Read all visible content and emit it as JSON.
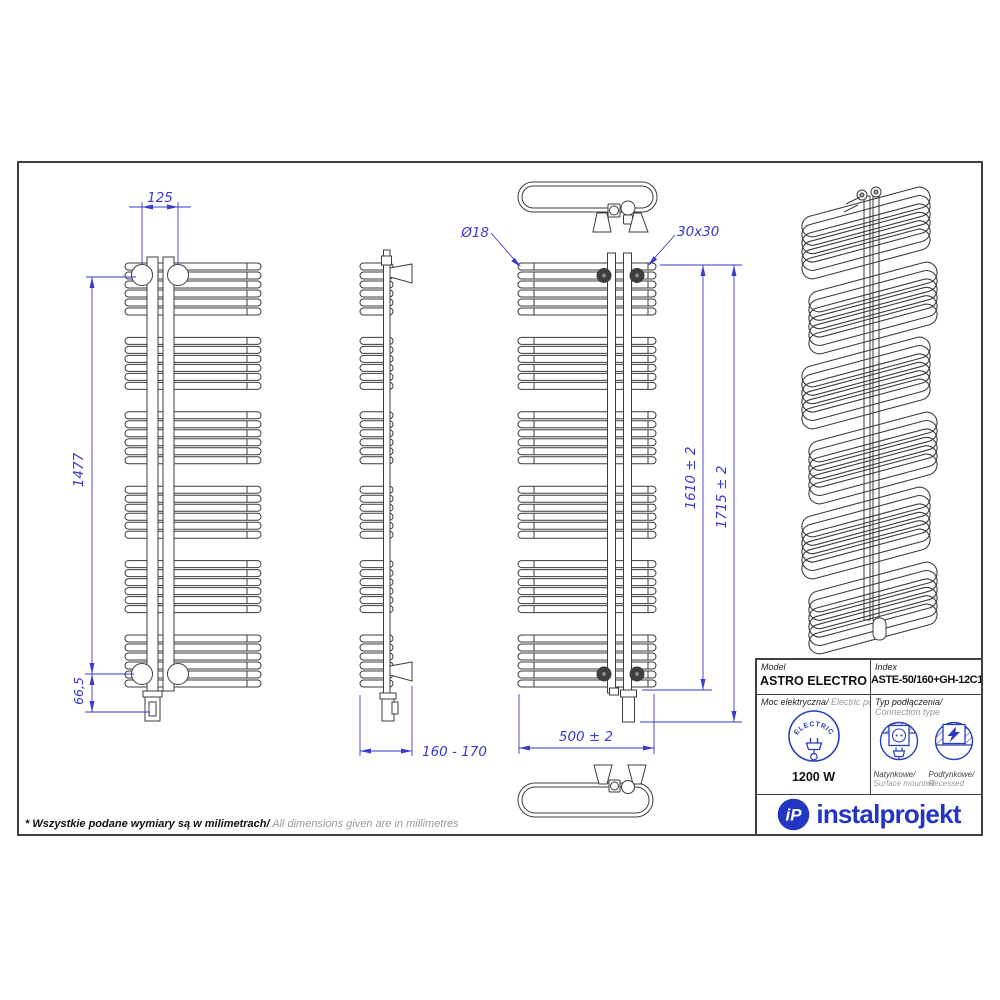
{
  "dimensions": {
    "top_width": "125",
    "height_main": "1477",
    "bottom_offset": "66,5",
    "depth_range": "160 - 170",
    "tube_diameter": "Ø18",
    "bracket_size": "30x30",
    "tube_height": "1610 ± 2",
    "total_height": "1715 ± 2",
    "width_total": "500 ± 2"
  },
  "drawing": {
    "groups": 6,
    "tubes_per_group": 6,
    "line_color": "#3c3c3c",
    "dim_color": "#3a3acc"
  },
  "table": {
    "model_label": "Model",
    "model_value": "ASTRO ELECTRO",
    "index_label": "Index",
    "index_value": "ASTE-50/160+GH-12C1",
    "power_label_pl": "Moc elektryczna/",
    "power_label_en": " Electric power",
    "power_value": "1200 W",
    "electric_icon_text": "ELECTRIC",
    "connection_label_pl": "Typ podłączenia/",
    "connection_label_en": "Connection type",
    "surface_label_pl": "Natynkowe/",
    "surface_label_en": "Surface mounted",
    "recessed_label_pl": "Podtynkowe/",
    "recessed_label_en": "Recessed",
    "icon_color": "#2a3fb8"
  },
  "logo": {
    "monogram": "iP",
    "text": "instalprojekt",
    "color": "#2336c3"
  },
  "footnote": {
    "bold": "* Wszystkie podane wymiary są w milimetrach/",
    "light": " All dimensions given are in millimetres"
  }
}
